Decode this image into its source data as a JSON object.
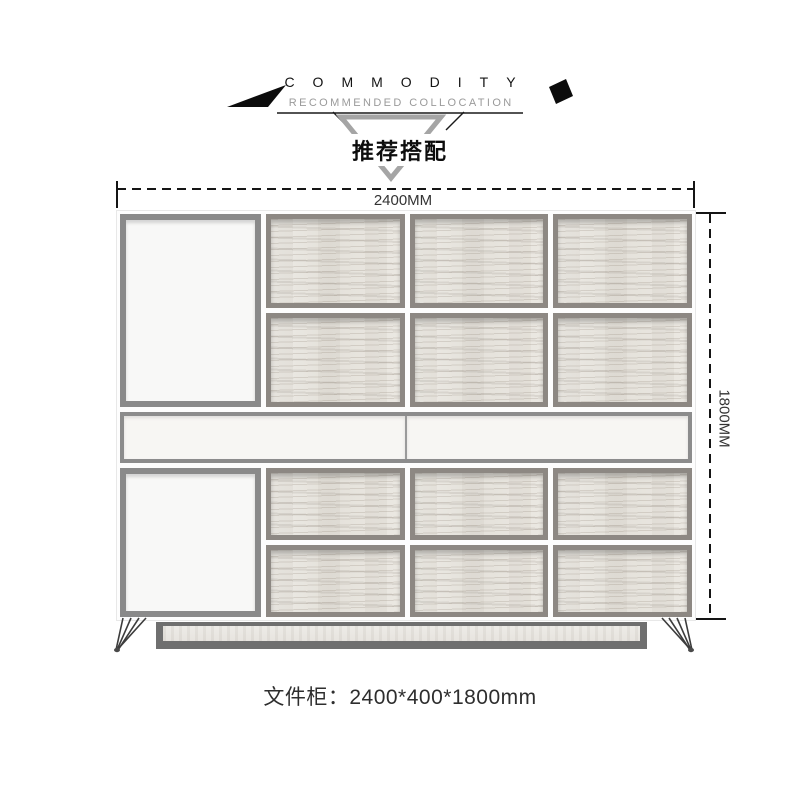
{
  "header": {
    "title": "COMMODITY",
    "subtitle": "RECOMMENDED COLLOCATION",
    "badge": "推荐搭配"
  },
  "dimensions": {
    "width_label": "2400MM",
    "height_label": "1800MM"
  },
  "caption": {
    "text": "文件柜：2400*400*1800mm"
  },
  "cabinet": {
    "type": "file-cabinet-front-view",
    "top_wood_panels": 6,
    "bottom_wood_panels": 6,
    "middle_drawers": 2,
    "left_doors": 2
  },
  "colors": {
    "frame_gray": "#8a8a8a",
    "wood_light": "#e9e6e0",
    "dim_line": "#151515",
    "subtitle_gray": "#9a9a9a",
    "triangle_gray": "#a5a5a5"
  }
}
